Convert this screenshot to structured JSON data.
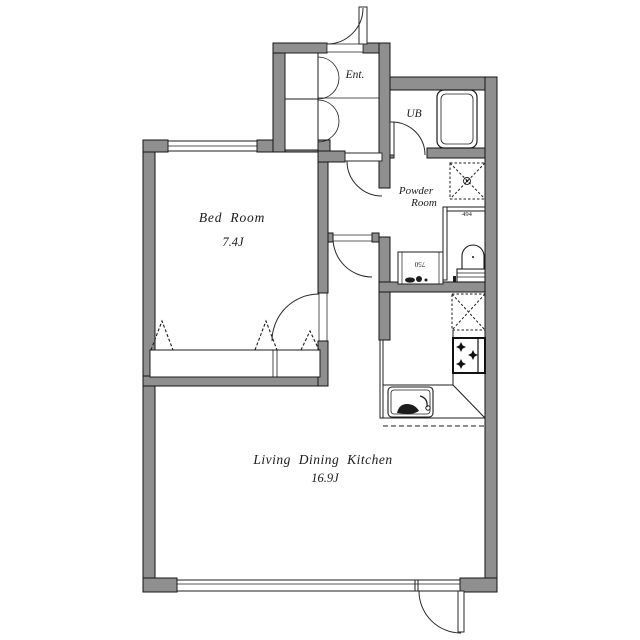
{
  "floor_plan": {
    "labels": {
      "entrance": "Ent.",
      "unit_bath": "UB",
      "powder_line1": "Powder",
      "powder_line2": "Room",
      "bedroom": "Bed Room",
      "bedroom_area": "7.4J",
      "ldk": "Living Dining Kitchen",
      "ldk_area": "16.9J",
      "vanity_dim": "750",
      "toilet_dim": "494"
    },
    "rooms": [
      {
        "id": "entrance",
        "label": "Ent."
      },
      {
        "id": "unit-bath",
        "label": "UB"
      },
      {
        "id": "powder-room",
        "label": "Powder Room"
      },
      {
        "id": "bedroom",
        "label": "Bed Room",
        "area": "7.4J"
      },
      {
        "id": "living-dining-kitchen",
        "label": "Living Dining Kitchen",
        "area": "16.9J"
      }
    ],
    "fixtures": [
      "bathtub",
      "washing-machine-pan",
      "toilet",
      "vanity-sink",
      "refrigerator-space",
      "gas-stove",
      "kitchen-counter",
      "kitchen-sink",
      "closet-hanger-rack",
      "shoe-cabinet",
      "entrance-door",
      "balcony-door",
      "sliding-window",
      "bedroom-window"
    ],
    "colors": {
      "wall": "#8f8f8f",
      "wall_outline": "#141414",
      "line": "#1c1c1c",
      "background": "#ffffff"
    }
  }
}
